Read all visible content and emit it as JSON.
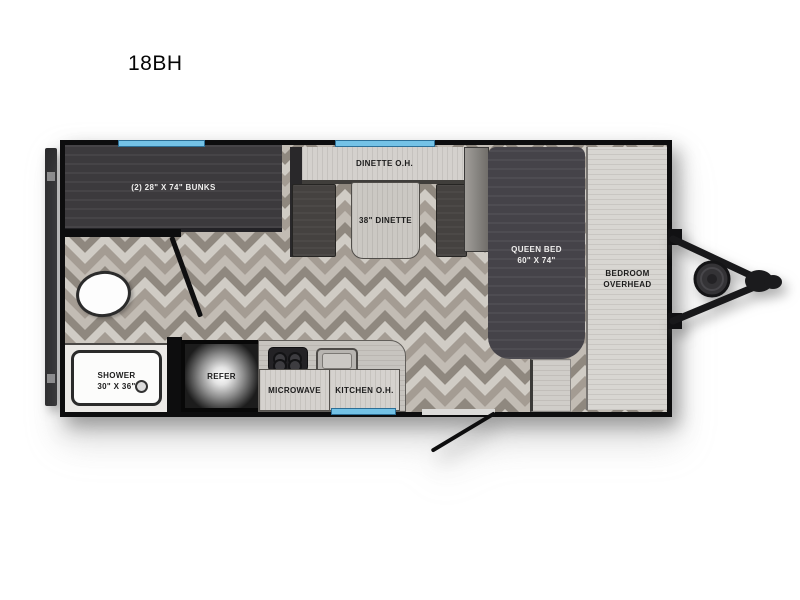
{
  "title": "18BH",
  "plan": {
    "bunks_label": "(2) 28\" X 74\" BUNKS",
    "dinette_overhead_label": "DINETTE O.H.",
    "dinette_label": "38\" DINETTE",
    "queen_bed_label_line1": "QUEEN BED",
    "queen_bed_label_line2": "60\" X 74\"",
    "bedroom_overhead_label_line1": "BEDROOM",
    "bedroom_overhead_label_line2": "OVERHEAD",
    "shower_label_line1": "SHOWER",
    "shower_label_line2": "30\" X 36\"",
    "refer_label": "REFER",
    "microwave_label": "MICROWAVE",
    "kitchen_overhead_label": "KITCHEN O.H."
  },
  "colors": {
    "window_blue": "#74c2e6",
    "wall_black": "#0d0d0e",
    "dark_furniture": "#454349",
    "light_cabinet": "#d5d2ce",
    "floor_light": "#d0ccc5",
    "floor_dark": "#8f887f"
  }
}
